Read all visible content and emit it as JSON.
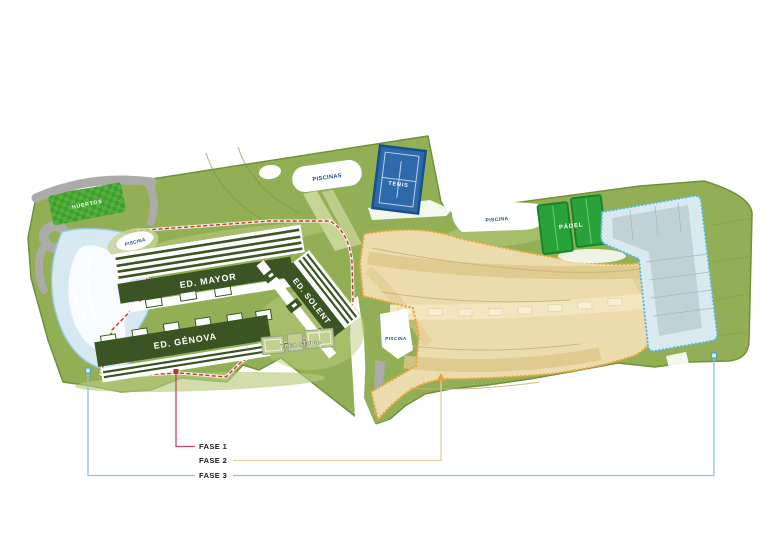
{
  "title": "Plan de fases del complejo residencial",
  "map": {
    "facilities": {
      "huertos": "HUERTOS",
      "piscinas": "PISCINAS",
      "tenis": "TENIS",
      "piscina_pond": "PISCINA",
      "ed_mayor": "ED. MAYOR",
      "ed_genova": "ED. GÉNOVA",
      "ed_solent": "ED. SOLENT",
      "yoga_studio": "YOGA STUDIO",
      "piscina_east": "PISCINA",
      "padel": "PÁDEL",
      "piscina_central": "PISCINA"
    },
    "legend": [
      {
        "label": "FASE 1",
        "color": "#c2476a",
        "marker_color": "#b03a3a"
      },
      {
        "label": "FASE 2",
        "color": "#ddd0a2",
        "marker_color": "#e8a33c"
      },
      {
        "label": "FASE 3",
        "color": "#8ec4d8",
        "marker_color": "#49a8c4"
      }
    ],
    "colors": {
      "parcel_green": "#92af55",
      "parcel_edge": "#71903c",
      "light_green": "#b9cb80",
      "path_green": "#c6d494",
      "building_green": "#3a5523",
      "huertos_green": "#54b13c",
      "huertos_check": "#3f9e2e",
      "tan_fill": "#ecdcad",
      "tan_band": "#dcc789",
      "tan_boundary": "#e9a63e",
      "road_gray": "#abacaa",
      "pond_fill": "#d6e9f3",
      "pond_edge": "#9cc7da",
      "tennis_fill": "#2e6aab",
      "tennis_edge": "#17518c",
      "padel_fill": "#2aa23a",
      "padel_edge": "#15852c",
      "future_fill": "#d8e9f0",
      "future_inner": "#bfd1d4",
      "future_edge": "#58b8d8",
      "fase1_boundary": "#c43a32"
    }
  }
}
